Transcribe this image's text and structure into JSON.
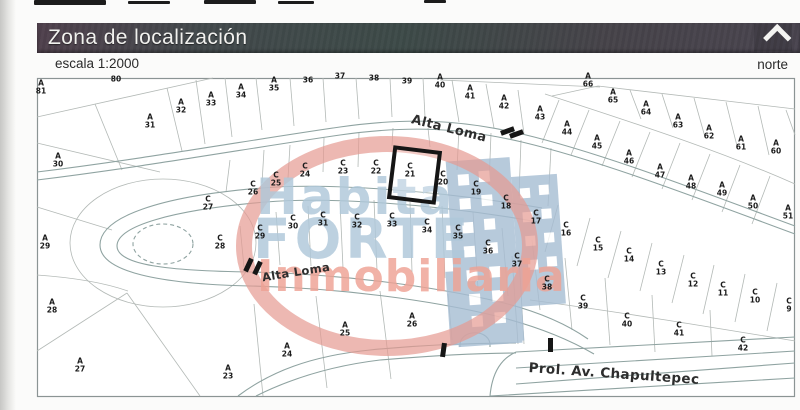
{
  "header": {
    "title": "Zona de localización",
    "scale": "escala 1:2000",
    "north_label": "norte",
    "bar_color": "#45434a"
  },
  "watermark": {
    "line1": "Habita",
    "line2": "FORTE",
    "line3": "Inmobiliaria",
    "text_color": "#afc8da",
    "accent_color": "#eea294",
    "ring_color": "#e69a92",
    "building_color": "#a6bdd3"
  },
  "map": {
    "highlight": {
      "label": "C 21",
      "x": 410,
      "y": 171,
      "w": 41,
      "h": 46,
      "rot": 7,
      "color": "#151515"
    },
    "streets": [
      {
        "name": "Alta Loma",
        "x": 449,
        "y": 129,
        "rot": 14,
        "size": 13
      },
      {
        "name": "Alta Loma",
        "x": 296,
        "y": 272,
        "rot": -9,
        "size": 11.5
      },
      {
        "name": "Prol. Av. Chapultepec",
        "x": 614,
        "y": 374,
        "rot": 4,
        "size": 13.5
      }
    ],
    "markers": [
      {
        "x": 507,
        "y": 131,
        "r": 70
      },
      {
        "x": 516,
        "y": 134,
        "r": 70
      },
      {
        "x": 248,
        "y": 265,
        "r": 25
      },
      {
        "x": 257,
        "y": 268,
        "r": 25
      },
      {
        "x": 443,
        "y": 350,
        "r": 8
      },
      {
        "x": 550,
        "y": 345,
        "r": 0
      }
    ],
    "lots": [
      {
        "t": "",
        "n": "80",
        "x": 116,
        "y": 80
      },
      {
        "t": "A",
        "n": "81",
        "x": 41,
        "y": 88
      },
      {
        "t": "A",
        "n": "30",
        "x": 58,
        "y": 161
      },
      {
        "t": "A",
        "n": "31",
        "x": 150,
        "y": 122
      },
      {
        "t": "A",
        "n": "32",
        "x": 181,
        "y": 107
      },
      {
        "t": "A",
        "n": "33",
        "x": 211,
        "y": 100
      },
      {
        "t": "A",
        "n": "34",
        "x": 241,
        "y": 92
      },
      {
        "t": "A",
        "n": "35",
        "x": 274,
        "y": 85
      },
      {
        "t": "",
        "n": "36",
        "x": 308,
        "y": 81
      },
      {
        "t": "",
        "n": "37",
        "x": 340,
        "y": 77
      },
      {
        "t": "",
        "n": "38",
        "x": 374,
        "y": 79
      },
      {
        "t": "",
        "n": "39",
        "x": 407,
        "y": 82
      },
      {
        "t": "A",
        "n": "40",
        "x": 440,
        "y": 82
      },
      {
        "t": "A",
        "n": "41",
        "x": 470,
        "y": 93
      },
      {
        "t": "A",
        "n": "42",
        "x": 504,
        "y": 103
      },
      {
        "t": "A",
        "n": "43",
        "x": 540,
        "y": 114
      },
      {
        "t": "A",
        "n": "44",
        "x": 567,
        "y": 129
      },
      {
        "t": "A",
        "n": "45",
        "x": 597,
        "y": 143
      },
      {
        "t": "A",
        "n": "46",
        "x": 629,
        "y": 158
      },
      {
        "t": "A",
        "n": "47",
        "x": 660,
        "y": 172
      },
      {
        "t": "A",
        "n": "48",
        "x": 691,
        "y": 183
      },
      {
        "t": "A",
        "n": "49",
        "x": 722,
        "y": 190
      },
      {
        "t": "A",
        "n": "50",
        "x": 753,
        "y": 203
      },
      {
        "t": "A",
        "n": "51",
        "x": 788,
        "y": 213
      },
      {
        "t": "A",
        "n": "66",
        "x": 588,
        "y": 81
      },
      {
        "t": "A",
        "n": "65",
        "x": 613,
        "y": 97
      },
      {
        "t": "A",
        "n": "64",
        "x": 646,
        "y": 109
      },
      {
        "t": "A",
        "n": "63",
        "x": 678,
        "y": 122
      },
      {
        "t": "A",
        "n": "62",
        "x": 709,
        "y": 133
      },
      {
        "t": "A",
        "n": "61",
        "x": 741,
        "y": 144
      },
      {
        "t": "A",
        "n": "60",
        "x": 776,
        "y": 148
      },
      {
        "t": "A",
        "n": "29",
        "x": 45,
        "y": 243
      },
      {
        "t": "A",
        "n": "28",
        "x": 52,
        "y": 307
      },
      {
        "t": "A",
        "n": "27",
        "x": 80,
        "y": 366
      },
      {
        "t": "A",
        "n": "23",
        "x": 228,
        "y": 373
      },
      {
        "t": "A",
        "n": "24",
        "x": 287,
        "y": 351
      },
      {
        "t": "A",
        "n": "25",
        "x": 345,
        "y": 330
      },
      {
        "t": "A",
        "n": "26",
        "x": 412,
        "y": 321
      },
      {
        "t": "C",
        "n": "27",
        "x": 208,
        "y": 204
      },
      {
        "t": "C",
        "n": "26",
        "x": 253,
        "y": 189
      },
      {
        "t": "C",
        "n": "25",
        "x": 276,
        "y": 180
      },
      {
        "t": "C",
        "n": "24",
        "x": 305,
        "y": 171
      },
      {
        "t": "C",
        "n": "23",
        "x": 343,
        "y": 168
      },
      {
        "t": "C",
        "n": "22",
        "x": 376,
        "y": 168
      },
      {
        "t": "C",
        "n": "21",
        "x": 410,
        "y": 171
      },
      {
        "t": "C",
        "n": "20",
        "x": 443,
        "y": 179
      },
      {
        "t": "C",
        "n": "19",
        "x": 476,
        "y": 189
      },
      {
        "t": "C",
        "n": "18",
        "x": 506,
        "y": 203
      },
      {
        "t": "C",
        "n": "17",
        "x": 536,
        "y": 218
      },
      {
        "t": "C",
        "n": "16",
        "x": 566,
        "y": 230
      },
      {
        "t": "C",
        "n": "15",
        "x": 598,
        "y": 245
      },
      {
        "t": "C",
        "n": "14",
        "x": 629,
        "y": 256
      },
      {
        "t": "C",
        "n": "13",
        "x": 661,
        "y": 269
      },
      {
        "t": "C",
        "n": "12",
        "x": 693,
        "y": 281
      },
      {
        "t": "C",
        "n": "11",
        "x": 723,
        "y": 290
      },
      {
        "t": "C",
        "n": "10",
        "x": 755,
        "y": 297
      },
      {
        "t": "C",
        "n": "9",
        "x": 789,
        "y": 306
      },
      {
        "t": "C",
        "n": "28",
        "x": 220,
        "y": 243
      },
      {
        "t": "C",
        "n": "29",
        "x": 260,
        "y": 233
      },
      {
        "t": "C",
        "n": "30",
        "x": 293,
        "y": 223
      },
      {
        "t": "C",
        "n": "31",
        "x": 323,
        "y": 220
      },
      {
        "t": "C",
        "n": "32",
        "x": 357,
        "y": 222
      },
      {
        "t": "C",
        "n": "33",
        "x": 392,
        "y": 221
      },
      {
        "t": "C",
        "n": "34",
        "x": 427,
        "y": 227
      },
      {
        "t": "C",
        "n": "35",
        "x": 458,
        "y": 233
      },
      {
        "t": "C",
        "n": "36",
        "x": 488,
        "y": 248
      },
      {
        "t": "C",
        "n": "37",
        "x": 517,
        "y": 261
      },
      {
        "t": "C",
        "n": "38",
        "x": 547,
        "y": 284
      },
      {
        "t": "C",
        "n": "39",
        "x": 583,
        "y": 303
      },
      {
        "t": "C",
        "n": "40",
        "x": 627,
        "y": 321
      },
      {
        "t": "C",
        "n": "41",
        "x": 679,
        "y": 330
      },
      {
        "t": "C",
        "n": "42",
        "x": 743,
        "y": 345
      }
    ]
  }
}
